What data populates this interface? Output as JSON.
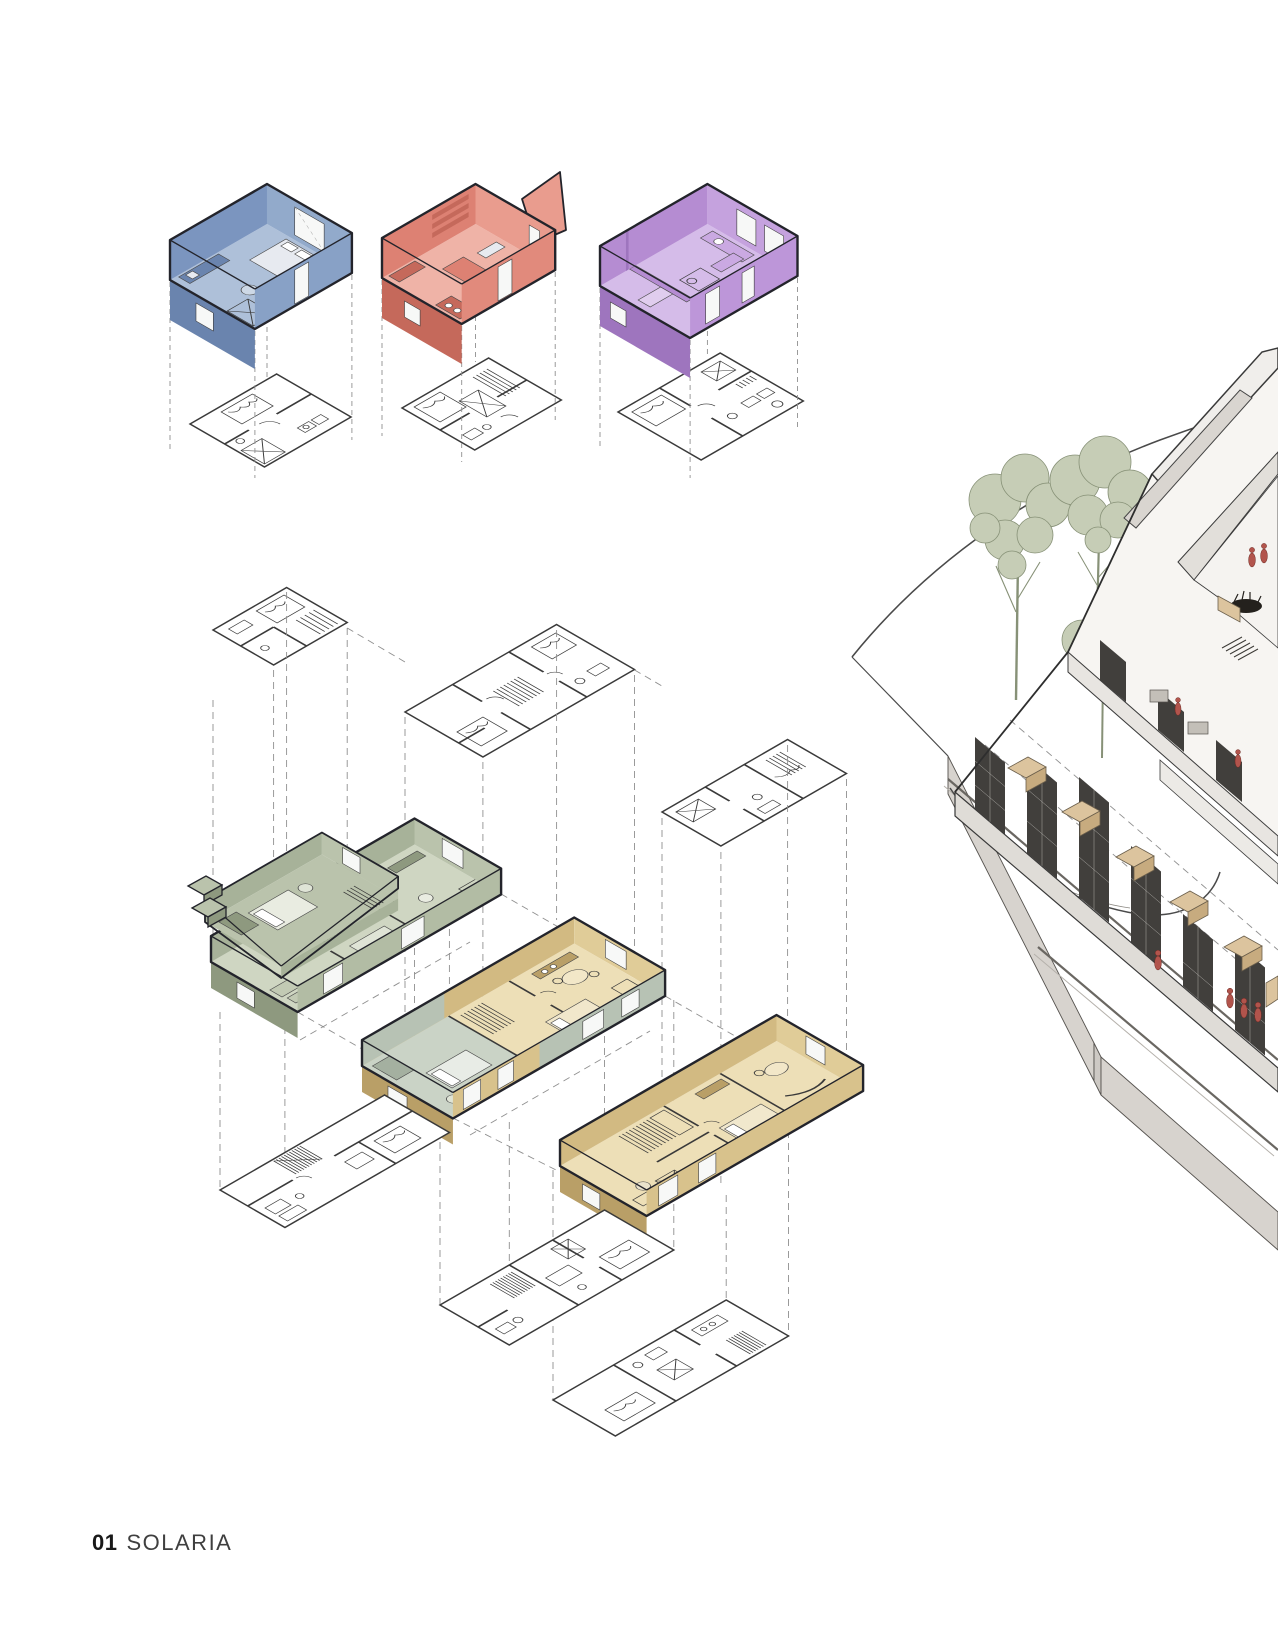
{
  "page": {
    "width": 1278,
    "height": 1650,
    "background": "#ffffff",
    "footer": {
      "number": "01",
      "title": "SOLARIA"
    }
  },
  "figures": {
    "unit_studies": {
      "name": "unit-axonometric-studies",
      "units": [
        {
          "id": "unit-axon-blue",
          "color_key": "blue_wall"
        },
        {
          "id": "unit-axon-red",
          "color_key": "red_wall"
        },
        {
          "id": "unit-axon-purple",
          "color_key": "purple_wall"
        }
      ]
    },
    "exploded_axon": {
      "name": "exploded-axonometric-stack",
      "units": [
        {
          "id": "duplex-axon-green",
          "color_key": "green_wall"
        },
        {
          "id": "unit-axon-tan-mid",
          "color_key": "tan_wall"
        },
        {
          "id": "unit-axon-tan-low",
          "color_key": "tan_wall"
        }
      ]
    },
    "site_render": {
      "name": "site-axonometric-render"
    }
  },
  "palette": {
    "ink": "#23242b",
    "plan_line": "#3a3a3a",
    "dash": "#8f8f8f",
    "glass": "#f7f8f7",
    "blue_wall": "#7b95bf",
    "blue_wall_light": "#92aacb",
    "blue_floor": "#aec0d9",
    "blue_band": "#88a1c6",
    "blue_dark": "#6a84ae",
    "red_wall": "#dd8173",
    "red_wall_light": "#e99c8e",
    "red_floor": "#efb3a7",
    "red_band": "#e18a7c",
    "red_dark": "#c5695b",
    "purple_wall": "#b58cd2",
    "purple_wall_light": "#c5a2de",
    "purple_floor": "#d5bce9",
    "purple_band": "#bd96d9",
    "purple_dark": "#9e75be",
    "green_wall": "#a7b299",
    "green_wall_light": "#bac3ac",
    "green_floor": "#cfd6c2",
    "green_band": "#b2bca4",
    "green_dark": "#8e997f",
    "tan_wall": "#d2ba82",
    "tan_wall_light": "#e0cc98",
    "tan_floor": "#eddfb7",
    "tan_band": "#d8c28c",
    "tan_dark": "#b99f67",
    "sage": "#b7c2b4",
    "sage_floor": "#cad3c6",
    "plinth_edge": "#d7d3ce",
    "plinth_stroke": "#55524e",
    "tree": "#c6cdb6",
    "tree_edge": "#879177",
    "road": "#6a6762",
    "road_light": "#b5b1ab",
    "curve": "#4a4a4a",
    "bld_plane": "#f7f5f2",
    "bld_slab": "#e8e5e1",
    "bld_slab2": "#dfdcd7",
    "bld_roof": "#f0eeeb",
    "bld_roof2": "#e2dfda",
    "mesh": "#413f3c",
    "wood": "#dcc49e",
    "wood_side": "#c7ab7f",
    "fig_red": "#b2544c",
    "furn_light": "#e7eaf0"
  }
}
